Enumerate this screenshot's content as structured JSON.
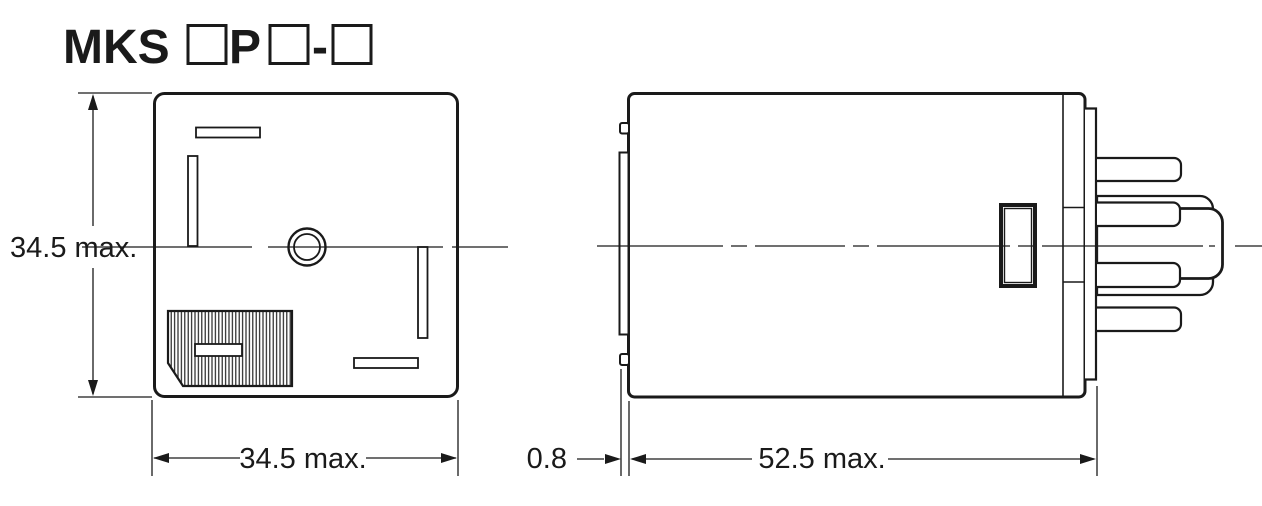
{
  "title": {
    "prefix": "MKS",
    "infix": "P",
    "separator": "-"
  },
  "dimensions": {
    "front_height": "34.5 max.",
    "front_width": "34.5 max.",
    "flange_offset": "0.8",
    "body_depth": "52.5 max."
  },
  "colors": {
    "line": "#1a1a1a",
    "background": "#ffffff"
  }
}
